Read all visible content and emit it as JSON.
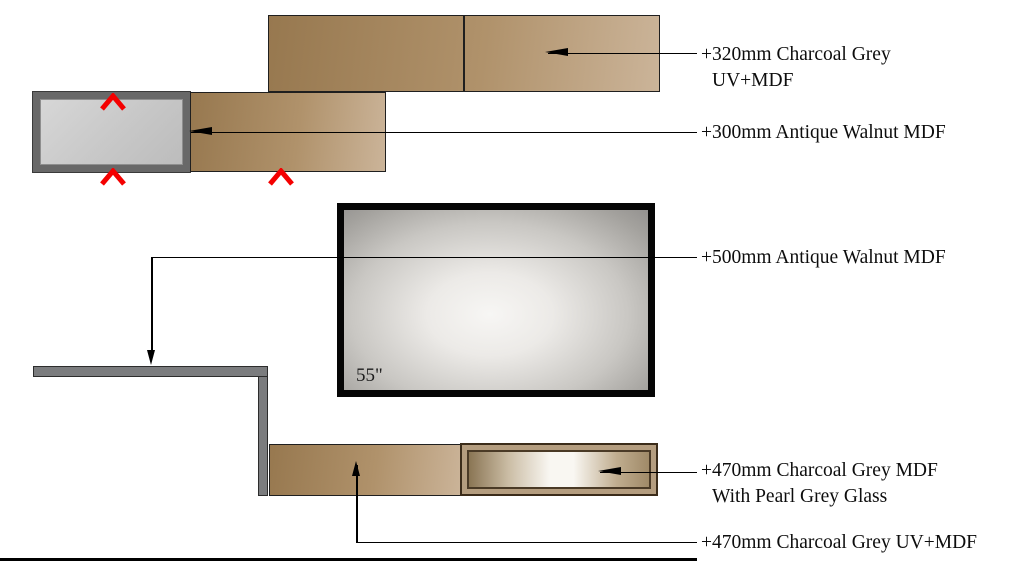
{
  "diagram": {
    "tv": {
      "size_label": "55\""
    },
    "annotations": [
      {
        "lines": [
          "+320mm Charcoal Grey",
          "UV+MDF"
        ]
      },
      {
        "lines": [
          "+300mm Antique Walnut MDF"
        ]
      },
      {
        "lines": [
          "+500mm Antique Walnut MDF"
        ]
      },
      {
        "lines": [
          "+470mm Charcoal Grey MDF",
          "With Pearl Grey Glass"
        ]
      },
      {
        "lines": [
          "+470mm Charcoal Grey UV+MDF"
        ]
      }
    ],
    "markers": {
      "red_chevron_count": 3,
      "marker_color": "#f40000"
    },
    "colors": {
      "wood_dark": "#97784f",
      "wood_light": "#cbb499",
      "charcoal_frame_grey": "#686868",
      "pearl_grey_panel": "#cccccc",
      "glass_tan": "#b49d7f",
      "glass_highlight": "#f9f7f2",
      "shelf_grey": "#7b7c7e",
      "line_black": "#000000"
    }
  }
}
